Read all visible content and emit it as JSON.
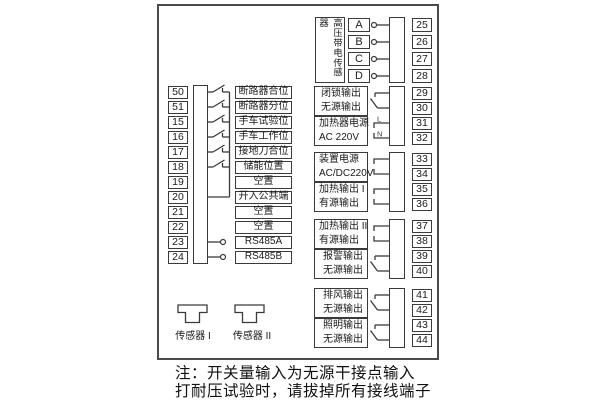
{
  "colors": {
    "line": "#3a3a3a",
    "border": "#4a4a4a",
    "background": "#ffffff",
    "text": "#1a1a1a"
  },
  "left_inputs": {
    "rows": [
      {
        "terminal": "50",
        "label": "断路器合位",
        "link": "switch"
      },
      {
        "terminal": "51",
        "label": "断路器分位",
        "link": "switch"
      },
      {
        "terminal": "15",
        "label": "手车试验位",
        "link": "switch"
      },
      {
        "terminal": "16",
        "label": "手车工作位",
        "link": "switch"
      },
      {
        "terminal": "17",
        "label": "接地刀合位",
        "link": "switch"
      },
      {
        "terminal": "18",
        "label": "储能位置",
        "link": "switch"
      },
      {
        "terminal": "19",
        "label": "空置",
        "link": "none"
      },
      {
        "terminal": "20",
        "label": "开入公共端",
        "link": "common"
      },
      {
        "terminal": "21",
        "label": "空置",
        "link": "none"
      },
      {
        "terminal": "22",
        "label": "空置",
        "link": "none"
      },
      {
        "terminal": "23",
        "label": "RS485A",
        "link": "stub"
      },
      {
        "terminal": "24",
        "label": "RS485B",
        "link": "stub"
      }
    ]
  },
  "hv_sensor": {
    "label_vertical": "高压带电传感器",
    "rows": [
      {
        "phase": "A",
        "terminal": "25"
      },
      {
        "phase": "B",
        "terminal": "26"
      },
      {
        "phase": "C",
        "terminal": "27"
      },
      {
        "phase": "D",
        "terminal": "28"
      }
    ]
  },
  "output_groups": [
    {
      "line1": "闭锁输出",
      "line2": "无源输出",
      "terminals": [
        "29",
        "30"
      ],
      "link": "contact"
    },
    {
      "line1": "加热器电源",
      "line2": "AC 220V",
      "terminals": [
        "31",
        "32"
      ],
      "link": "ln",
      "wire_labels": [
        "L",
        "N"
      ]
    },
    {
      "line1": "装置电源",
      "line2": "AC/DC220V",
      "terminals": [
        "33",
        "34"
      ],
      "link": "bracket"
    },
    {
      "line1": "加热输出 I",
      "line2": "有源输出",
      "terminals": [
        "35",
        "36"
      ],
      "link": "bracket"
    },
    {
      "line1": "加热输出 II",
      "line2": "有源输出",
      "terminals": [
        "37",
        "38"
      ],
      "link": "bracket"
    },
    {
      "line1": "报警输出",
      "line2": "无源输出",
      "terminals": [
        "39",
        "40"
      ],
      "link": "contact"
    },
    {
      "line1": "排风输出",
      "line2": "无源输出",
      "terminals": [
        "41",
        "42"
      ],
      "link": "contact"
    },
    {
      "line1": "照明输出",
      "line2": "无源输出",
      "terminals": [
        "43",
        "44"
      ],
      "link": "contact"
    }
  ],
  "sensors": [
    {
      "label": "传感器 I"
    },
    {
      "label": "传感器 II"
    }
  ],
  "note": {
    "line1": "注：开关量输入为无源干接点输入",
    "line2": "打耐压试验时，请拔掉所有接线端子"
  }
}
